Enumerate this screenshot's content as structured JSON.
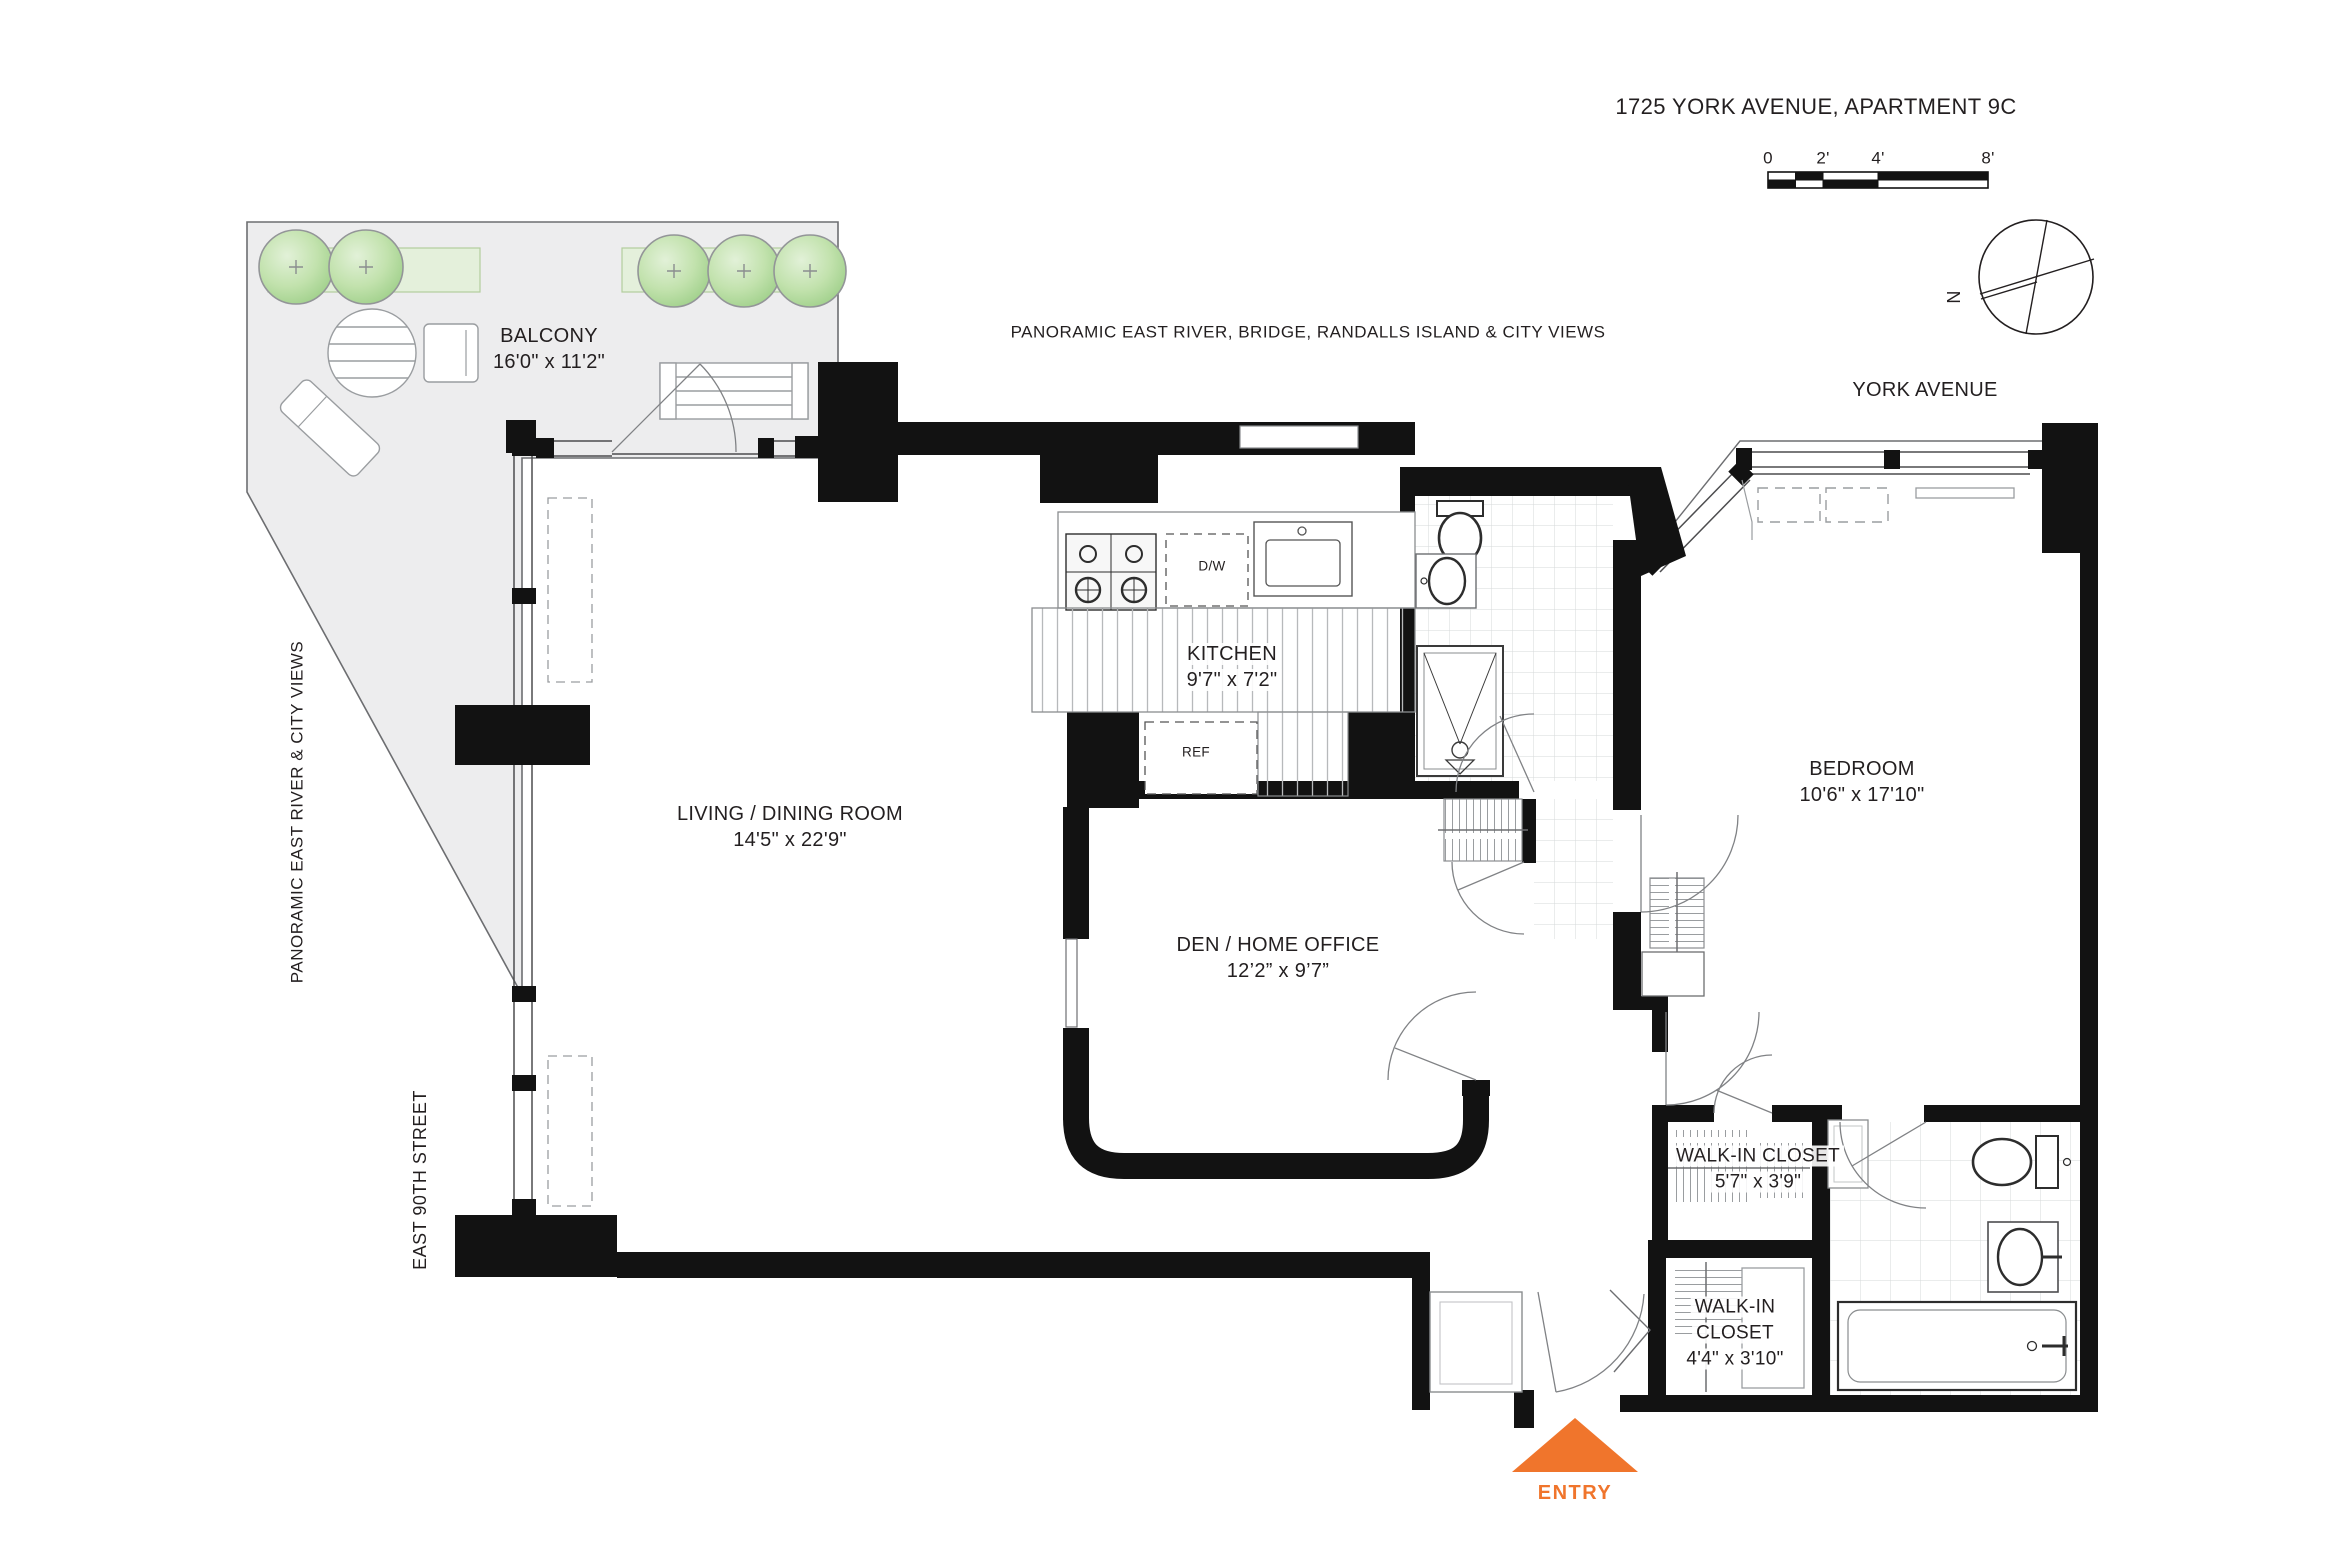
{
  "title": "1725 YORK AVENUE, APARTMENT 9C",
  "scale_bar": {
    "labels": [
      "0",
      "2'",
      "4'",
      "8'"
    ]
  },
  "compass": {
    "north_label": "N"
  },
  "streets": {
    "york_avenue": "YORK AVENUE",
    "east_90th": "EAST 90TH STREET"
  },
  "views": {
    "north": "PANORAMIC EAST RIVER, BRIDGE, RANDALLS ISLAND & CITY VIEWS",
    "west": "PANORAMIC EAST RIVER & CITY VIEWS"
  },
  "rooms": {
    "balcony": {
      "name": "BALCONY",
      "dims": "16'0\" x 11'2\""
    },
    "living": {
      "name": "LIVING / DINING ROOM",
      "dims": "14'5\" x 22'9\""
    },
    "kitchen": {
      "name": "KITCHEN",
      "dims": "9'7\" x 7'2\""
    },
    "den": {
      "name": "DEN / HOME OFFICE",
      "dims": "12’2” x 9’7”"
    },
    "bedroom": {
      "name": "BEDROOM",
      "dims": "10'6\" x 17'10\""
    },
    "wic1": {
      "name": "WALK-IN CLOSET",
      "dims": "5'7\" x 3'9\""
    },
    "wic2": {
      "line1": "WALK-IN",
      "line2": "CLOSET",
      "dims": "4'4\" x 3'10\""
    }
  },
  "appliances": {
    "dishwasher": "D/W",
    "refrigerator": "REF"
  },
  "entry": {
    "label": "ENTRY"
  },
  "colors": {
    "wall": "#121212",
    "text": "#231f20",
    "entry_orange": "#f0752c",
    "balcony_fill": "#ededee",
    "tree_green": "#a8d494",
    "planter_green": "#e4f0db",
    "tile_line": "#d6d8da",
    "thin_line": "#808285"
  }
}
